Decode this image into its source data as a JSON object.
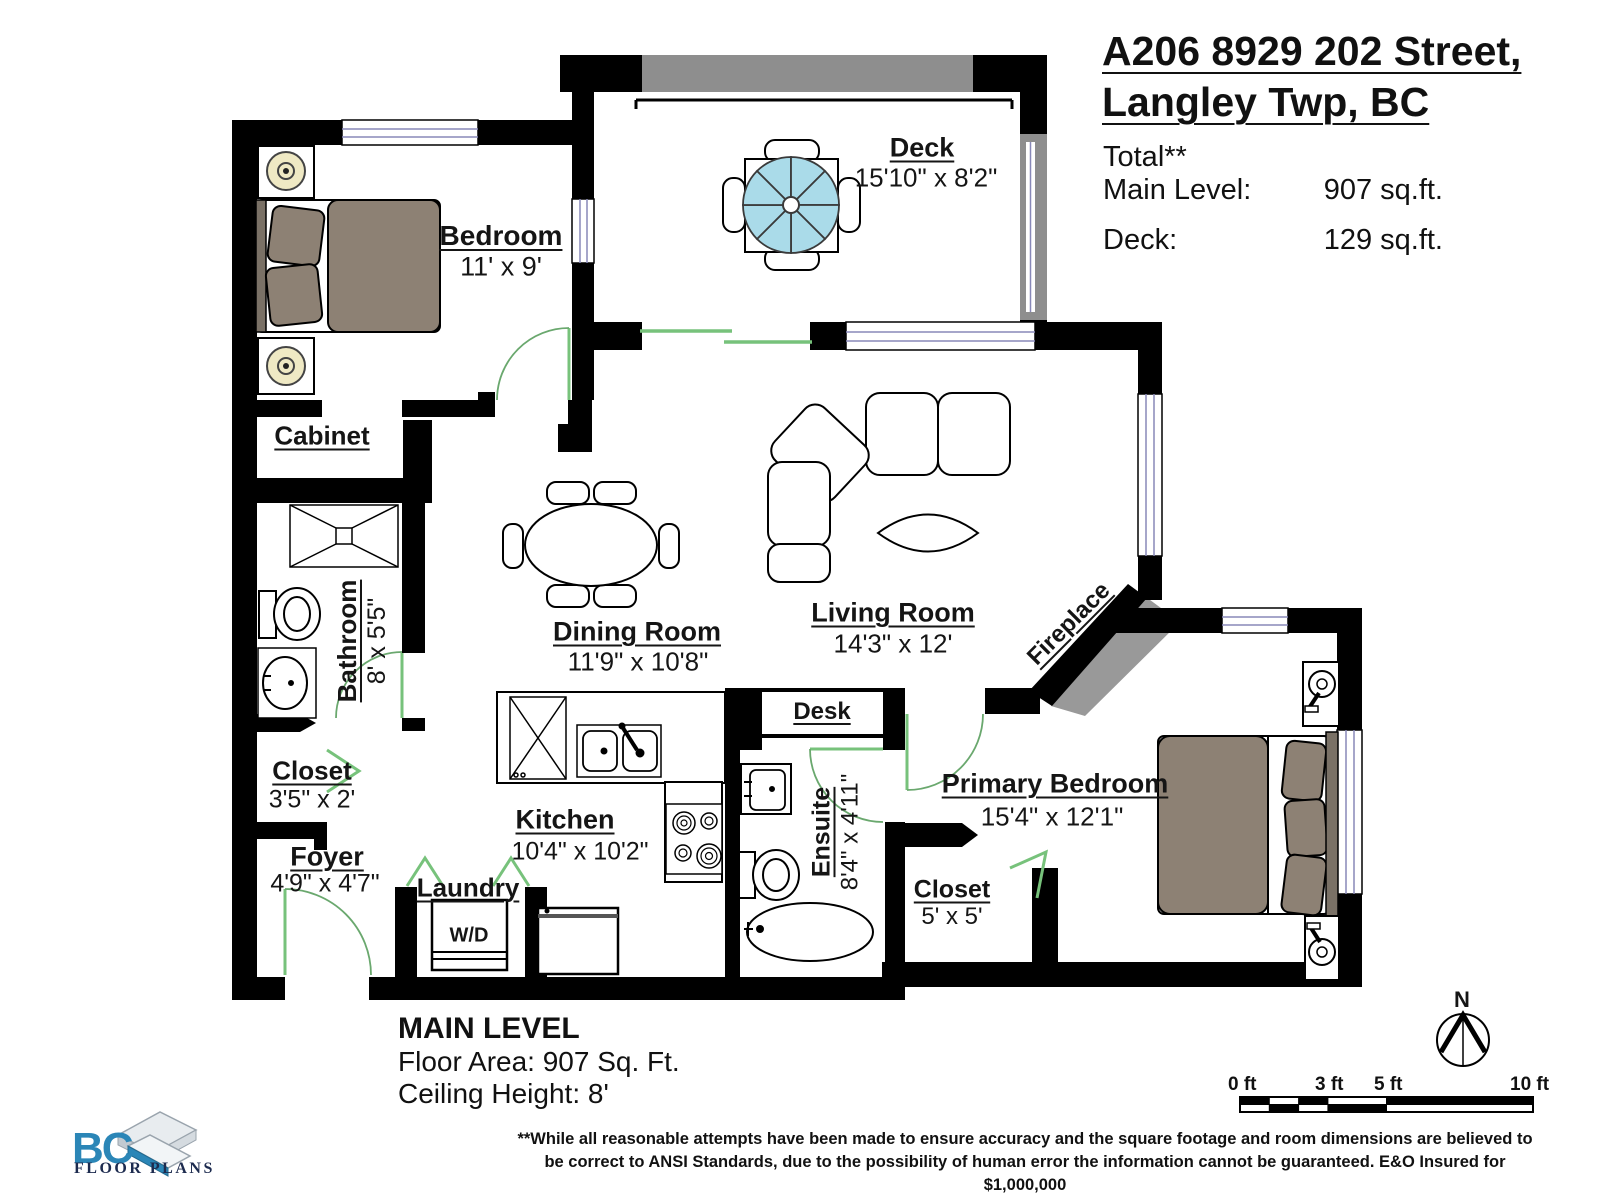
{
  "header": {
    "title_line1": "A206 8929 202 Street,",
    "title_line2": "Langley Twp, BC",
    "total_label": "Total**",
    "main_level_label": "Main Level:",
    "main_level_value": "907 sq.ft.",
    "deck_label": "Deck:",
    "deck_value": "129 sq.ft."
  },
  "rooms": {
    "bedroom": {
      "name": "Bedroom",
      "dims": "11' x 9'"
    },
    "deck": {
      "name": "Deck",
      "dims": "15'10\" x 8'2\""
    },
    "cabinet": {
      "name": "Cabinet"
    },
    "bathroom": {
      "name": "Bathroom",
      "dims": "8' x 5'5\""
    },
    "closet_hall": {
      "name": "Closet",
      "dims": "3'5\" x 2'"
    },
    "foyer": {
      "name": "Foyer",
      "dims": "4'9\" x 4'7\""
    },
    "laundry": {
      "name": "Laundry",
      "appliance": "W/D"
    },
    "kitchen": {
      "name": "Kitchen",
      "dims": "10'4\" x 10'2\""
    },
    "dining": {
      "name": "Dining Room",
      "dims": "11'9\" x 10'8\""
    },
    "living": {
      "name": "Living Room",
      "dims": "14'3\" x 12'"
    },
    "desk": {
      "name": "Desk"
    },
    "ensuite": {
      "name": "Ensuite",
      "dims": "8'4\" x 4'11\""
    },
    "closet_primary": {
      "name": "Closet",
      "dims": "5' x 5'"
    },
    "primary": {
      "name": "Primary Bedroom",
      "dims": "15'4\" x 12'1\""
    },
    "fireplace": {
      "name": "Fireplace"
    }
  },
  "footer": {
    "level_title": "MAIN LEVEL",
    "floor_area": "Floor Area: 907 Sq. Ft.",
    "ceiling_height": "Ceiling Height: 8'",
    "disclaimer_line1": "**While all reasonable attempts have been made to ensure accuracy and the square footage and room dimensions are believed to",
    "disclaimer_line2": "be correct to ANSI Standards, due to the possibility of human error the information cannot be guaranteed. E&O Insured for $1,000,000"
  },
  "logo": {
    "abbr": "BC",
    "text": "FLOOR PLANS"
  },
  "compass": {
    "north_label": "N"
  },
  "scale_bar": {
    "labels": [
      "0 ft",
      "3 ft",
      "5 ft",
      "10 ft"
    ]
  },
  "colors": {
    "wall_black": "#000000",
    "door_green": "#77c27b",
    "railing_gray": "#8e8e8e",
    "fireplace_gray": "#999999",
    "umbrella_blue": "#aadbe9",
    "furniture_taupe": "#8d8174",
    "lamp_yellow": "#efe9c4",
    "window_line": "#8888b8",
    "logo_blue": "#2b86b7"
  }
}
